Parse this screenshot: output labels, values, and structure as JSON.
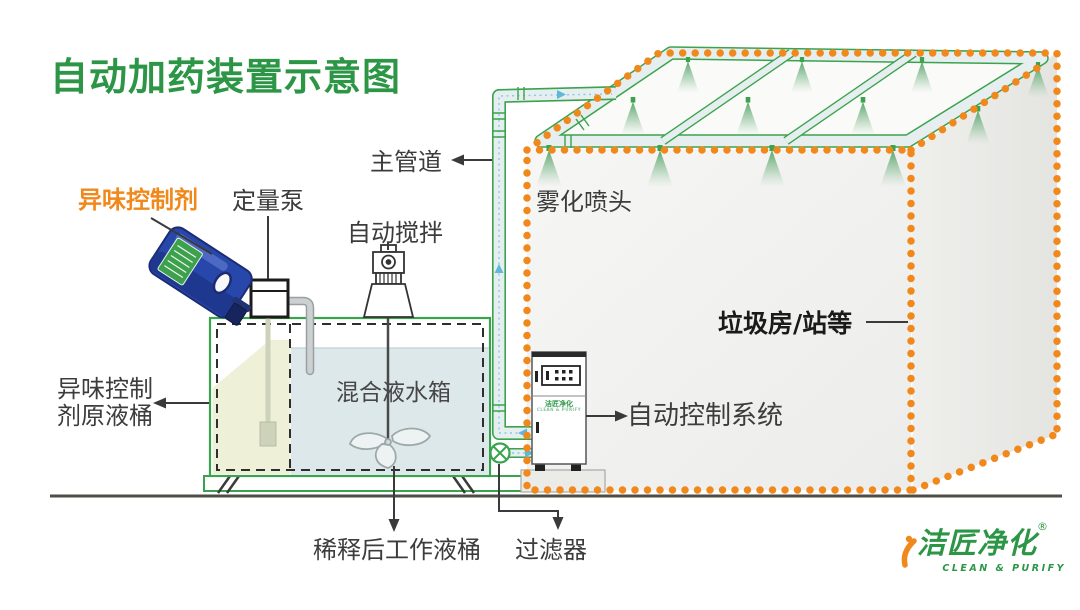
{
  "title": "自动加药装置示意图",
  "labels": {
    "odor_agent": "异味控制剂",
    "metering_pump": "定量泵",
    "auto_stir": "自动搅拌",
    "main_pipe": "主管道",
    "spray_nozzle": "雾化喷头",
    "garbage_room": "垃圾房/站等",
    "mixed_tank": "混合液水箱",
    "stock_barrel_line1": "异味控制",
    "stock_barrel_line2": "剂原液桶",
    "control_system": "自动控制系统",
    "diluted_barrel": "稀释后工作液桶",
    "filter": "过滤器"
  },
  "cabinet": {
    "logo": "洁匠净化",
    "slogan": "CLEAN & PURIFY"
  },
  "brand": {
    "name": "洁匠净化",
    "registered": "®",
    "slogan": "CLEAN & PURIFY"
  },
  "colors": {
    "title_green": "#2C9646",
    "accent_orange": "#F1881C",
    "pipe_green": "#3aa34d",
    "water_blue": "#dde8ea",
    "stock_cell_yellow": "#eef0d8",
    "jug_blue": "#2847ab",
    "label_text": "#3c3c3c"
  }
}
